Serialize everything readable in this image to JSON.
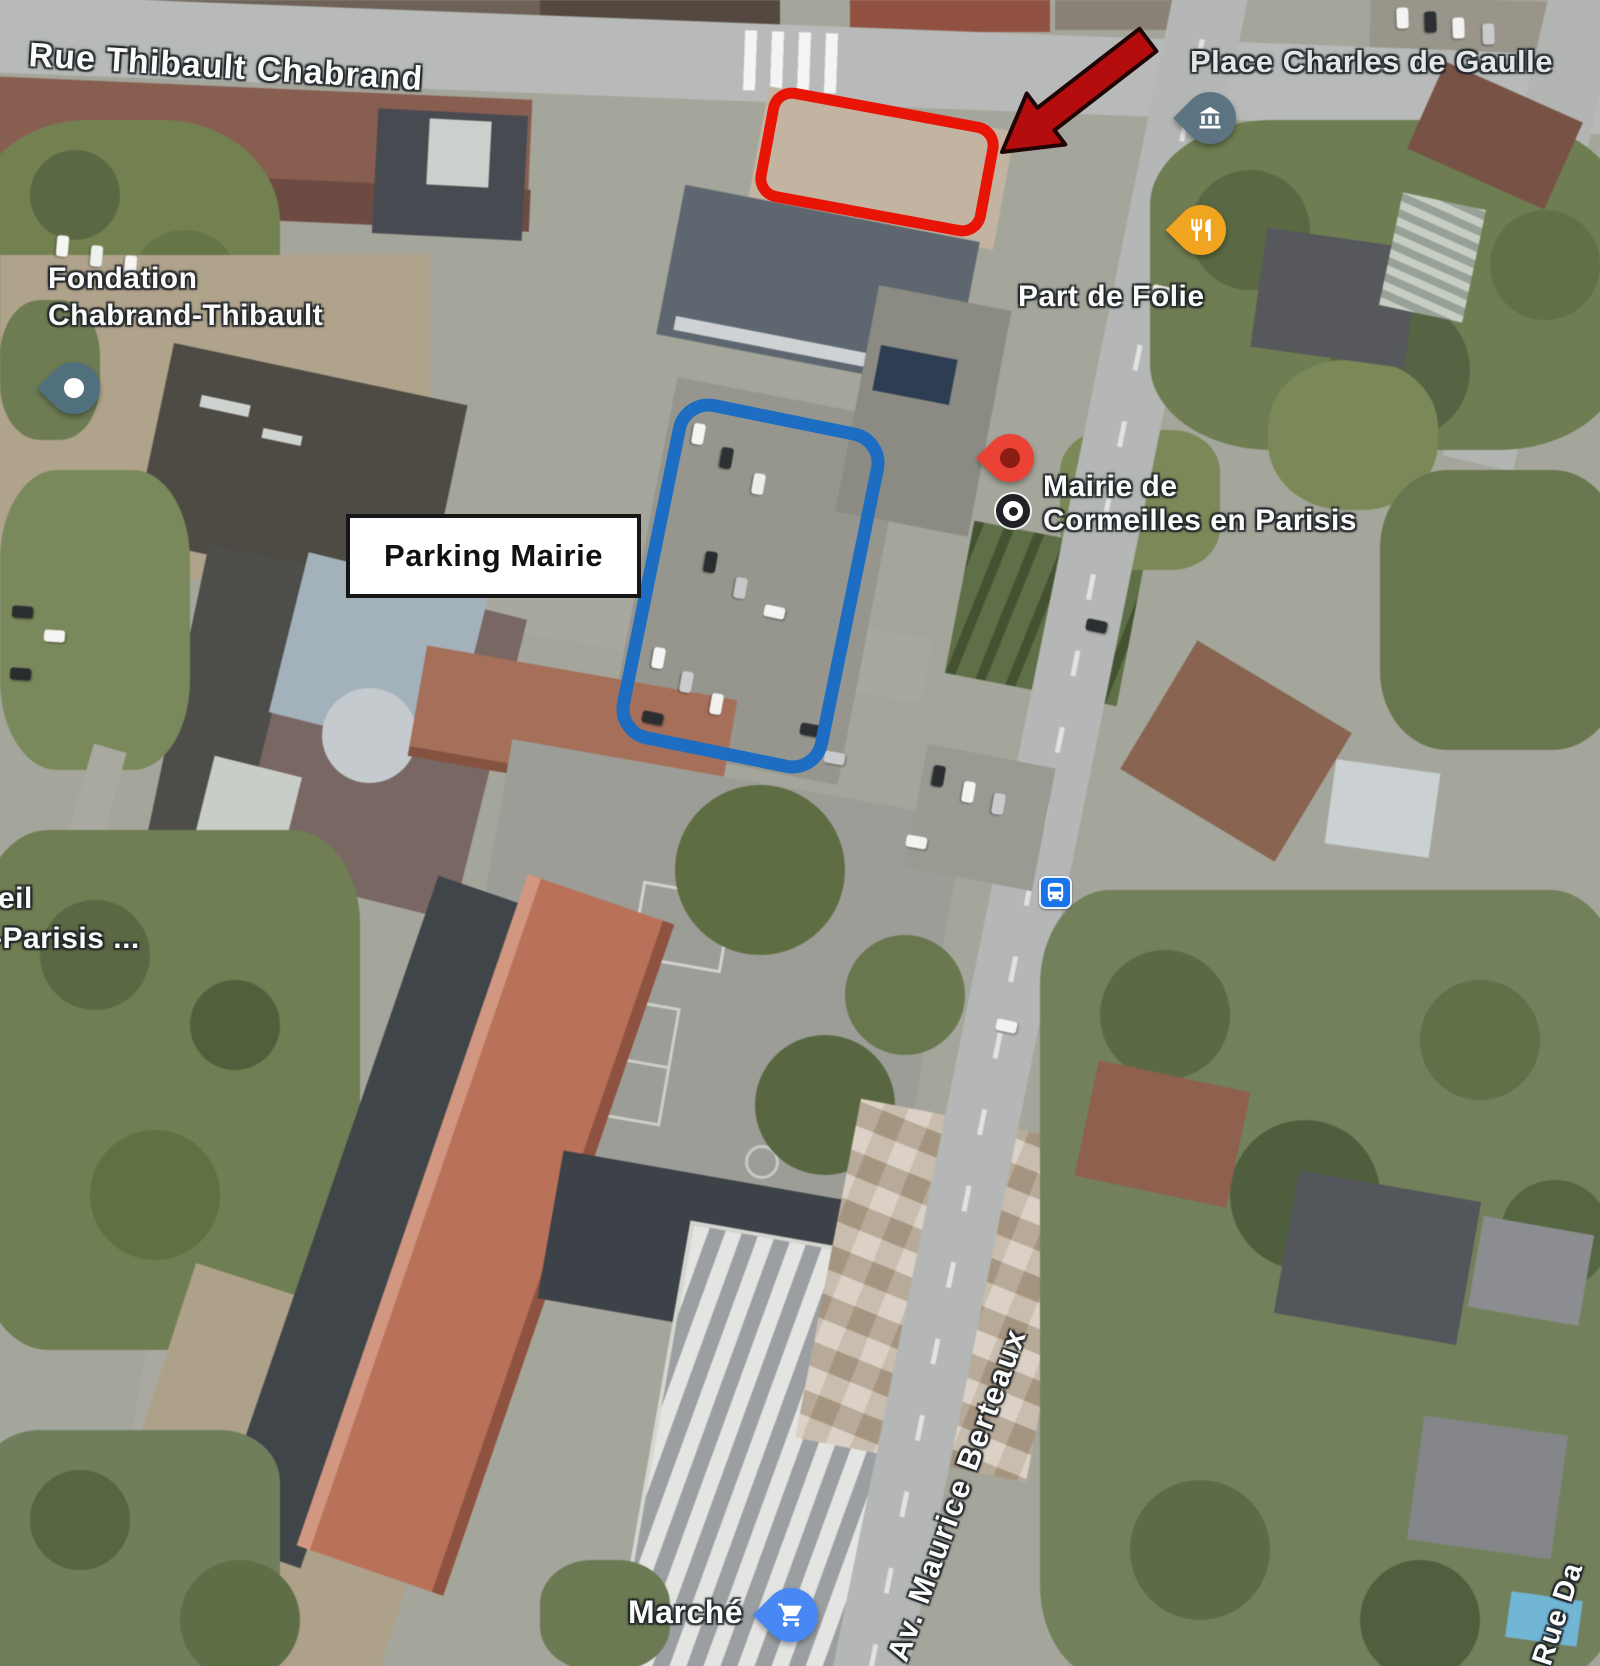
{
  "labels": {
    "rue_thibault": "Rue Thibault Chabrand",
    "place_charles": "Place Charles de Gaulle",
    "fondation_1": "Fondation",
    "fondation_2": "Chabrand-Thibault",
    "part_de_folie": "Part de Folie",
    "mairie_1": "Mairie de",
    "mairie_2": "Cormeilles en Parisis",
    "avenue": "Av. Maurice Berteaux",
    "marche": "Marché",
    "left_partial_1": "eil",
    "left_partial_2": "-Parisis ...",
    "rue_partial": "Rue Da"
  },
  "annotations": {
    "parking_label": "Parking Mairie",
    "highlight_red": "#e81507",
    "highlight_blue": "#1d6ec2",
    "arrow_fill": "#b50d0d",
    "arrow_outline": "#200505"
  },
  "pins": {
    "place_landmark": {
      "icon": "bank-icon",
      "color": "#5c7482"
    },
    "restaurant": {
      "icon": "restaurant-icon",
      "color": "#f0a41f"
    },
    "fondation": {
      "icon": "dot-icon",
      "color": "#51707e"
    },
    "mairie": {
      "icon": "pin-icon",
      "color": "#ea4335",
      "inner": "#8a1c12"
    },
    "market": {
      "icon": "cart-icon",
      "color": "#4788f4"
    },
    "bus_stop": {
      "icon": "bus-icon",
      "color": "#1a73e8"
    }
  }
}
